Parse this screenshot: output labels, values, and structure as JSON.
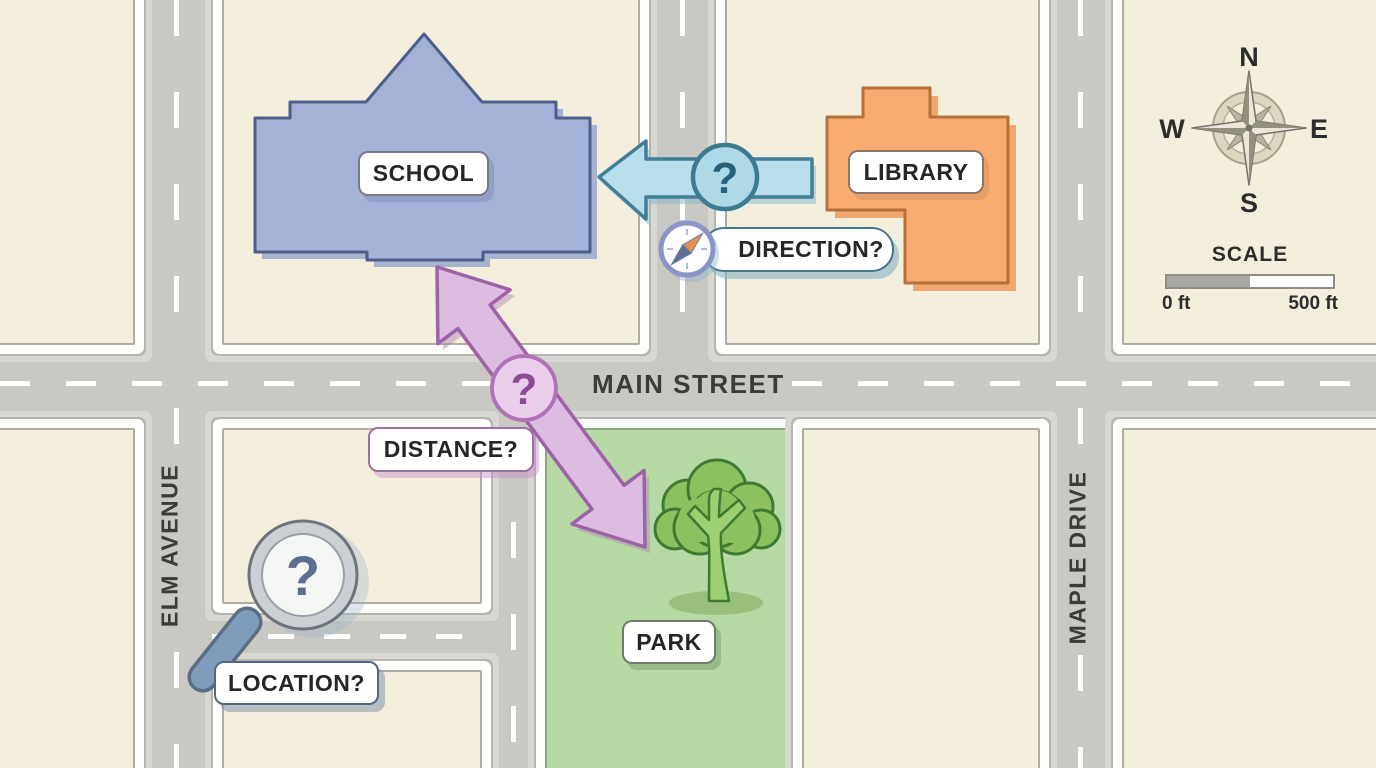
{
  "title": "neighborhood map illustration",
  "streets": {
    "main": "MAIN STREET",
    "elm": "ELM AVENUE",
    "maple": "MAPLE DRIVE"
  },
  "places": {
    "school": "SCHOOL",
    "library": "LIBRARY",
    "park": "PARK"
  },
  "questions": {
    "direction": {
      "label": "DIRECTION?",
      "mark": "?"
    },
    "distance": {
      "label": "DISTANCE?",
      "mark": "?"
    },
    "location": {
      "label": "LOCATION?",
      "mark": "?"
    }
  },
  "compass": {
    "north": "N",
    "east": "E",
    "south": "S",
    "west": "W"
  },
  "scale": {
    "title": "SCALE",
    "min": "0 ft",
    "max": "500 ft"
  },
  "colors": {
    "block_fill": "#f4eedd",
    "road_fill": "#c9c8c2",
    "school_fill": "#a5b2d8",
    "library_fill": "#f7ab70",
    "park_fill": "#b7d9a4",
    "tree_canopy": "#8cc15f",
    "direction_arrow": "#b9dfec",
    "distance_arrow": "#ddbce1"
  }
}
